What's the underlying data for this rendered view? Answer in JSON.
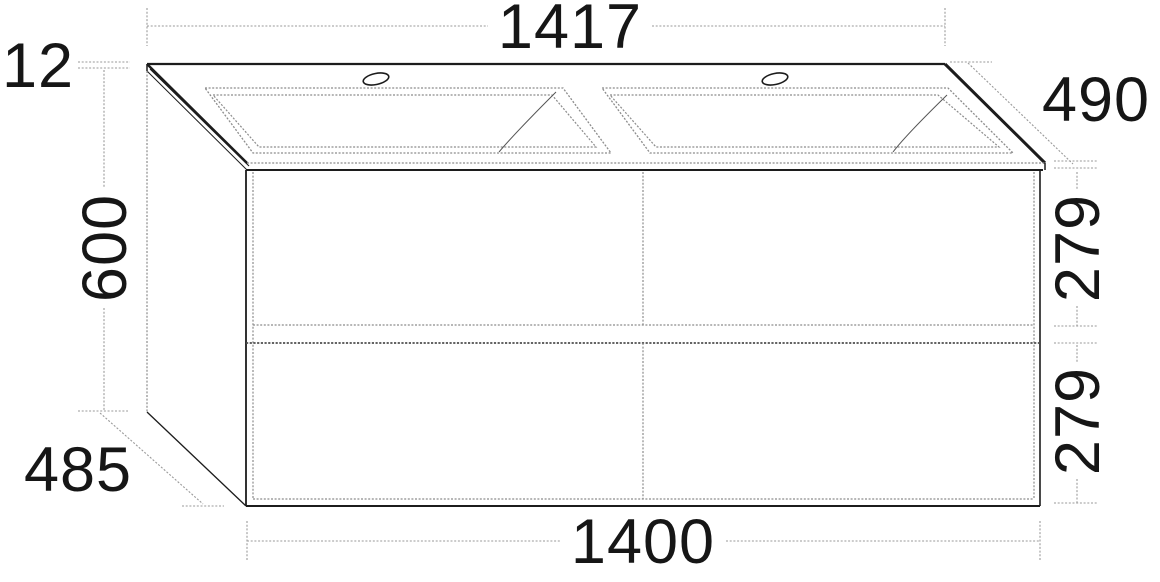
{
  "drawing": {
    "type": "technical-dimension-drawing",
    "subject": "double washbasin vanity unit with four drawers",
    "units": "mm",
    "dimensions": {
      "top_width": "1417",
      "top_thickness": "12",
      "top_depth": "490",
      "height": "600",
      "upper_drawer_height": "279",
      "lower_drawer_height": "279",
      "cabinet_depth": "485",
      "cabinet_width": "1400"
    },
    "colors": {
      "line": "#1c1c1c",
      "detail_line": "#8c8c8c",
      "dimension_line": "#9a9a9a",
      "background": "#ffffff"
    }
  }
}
